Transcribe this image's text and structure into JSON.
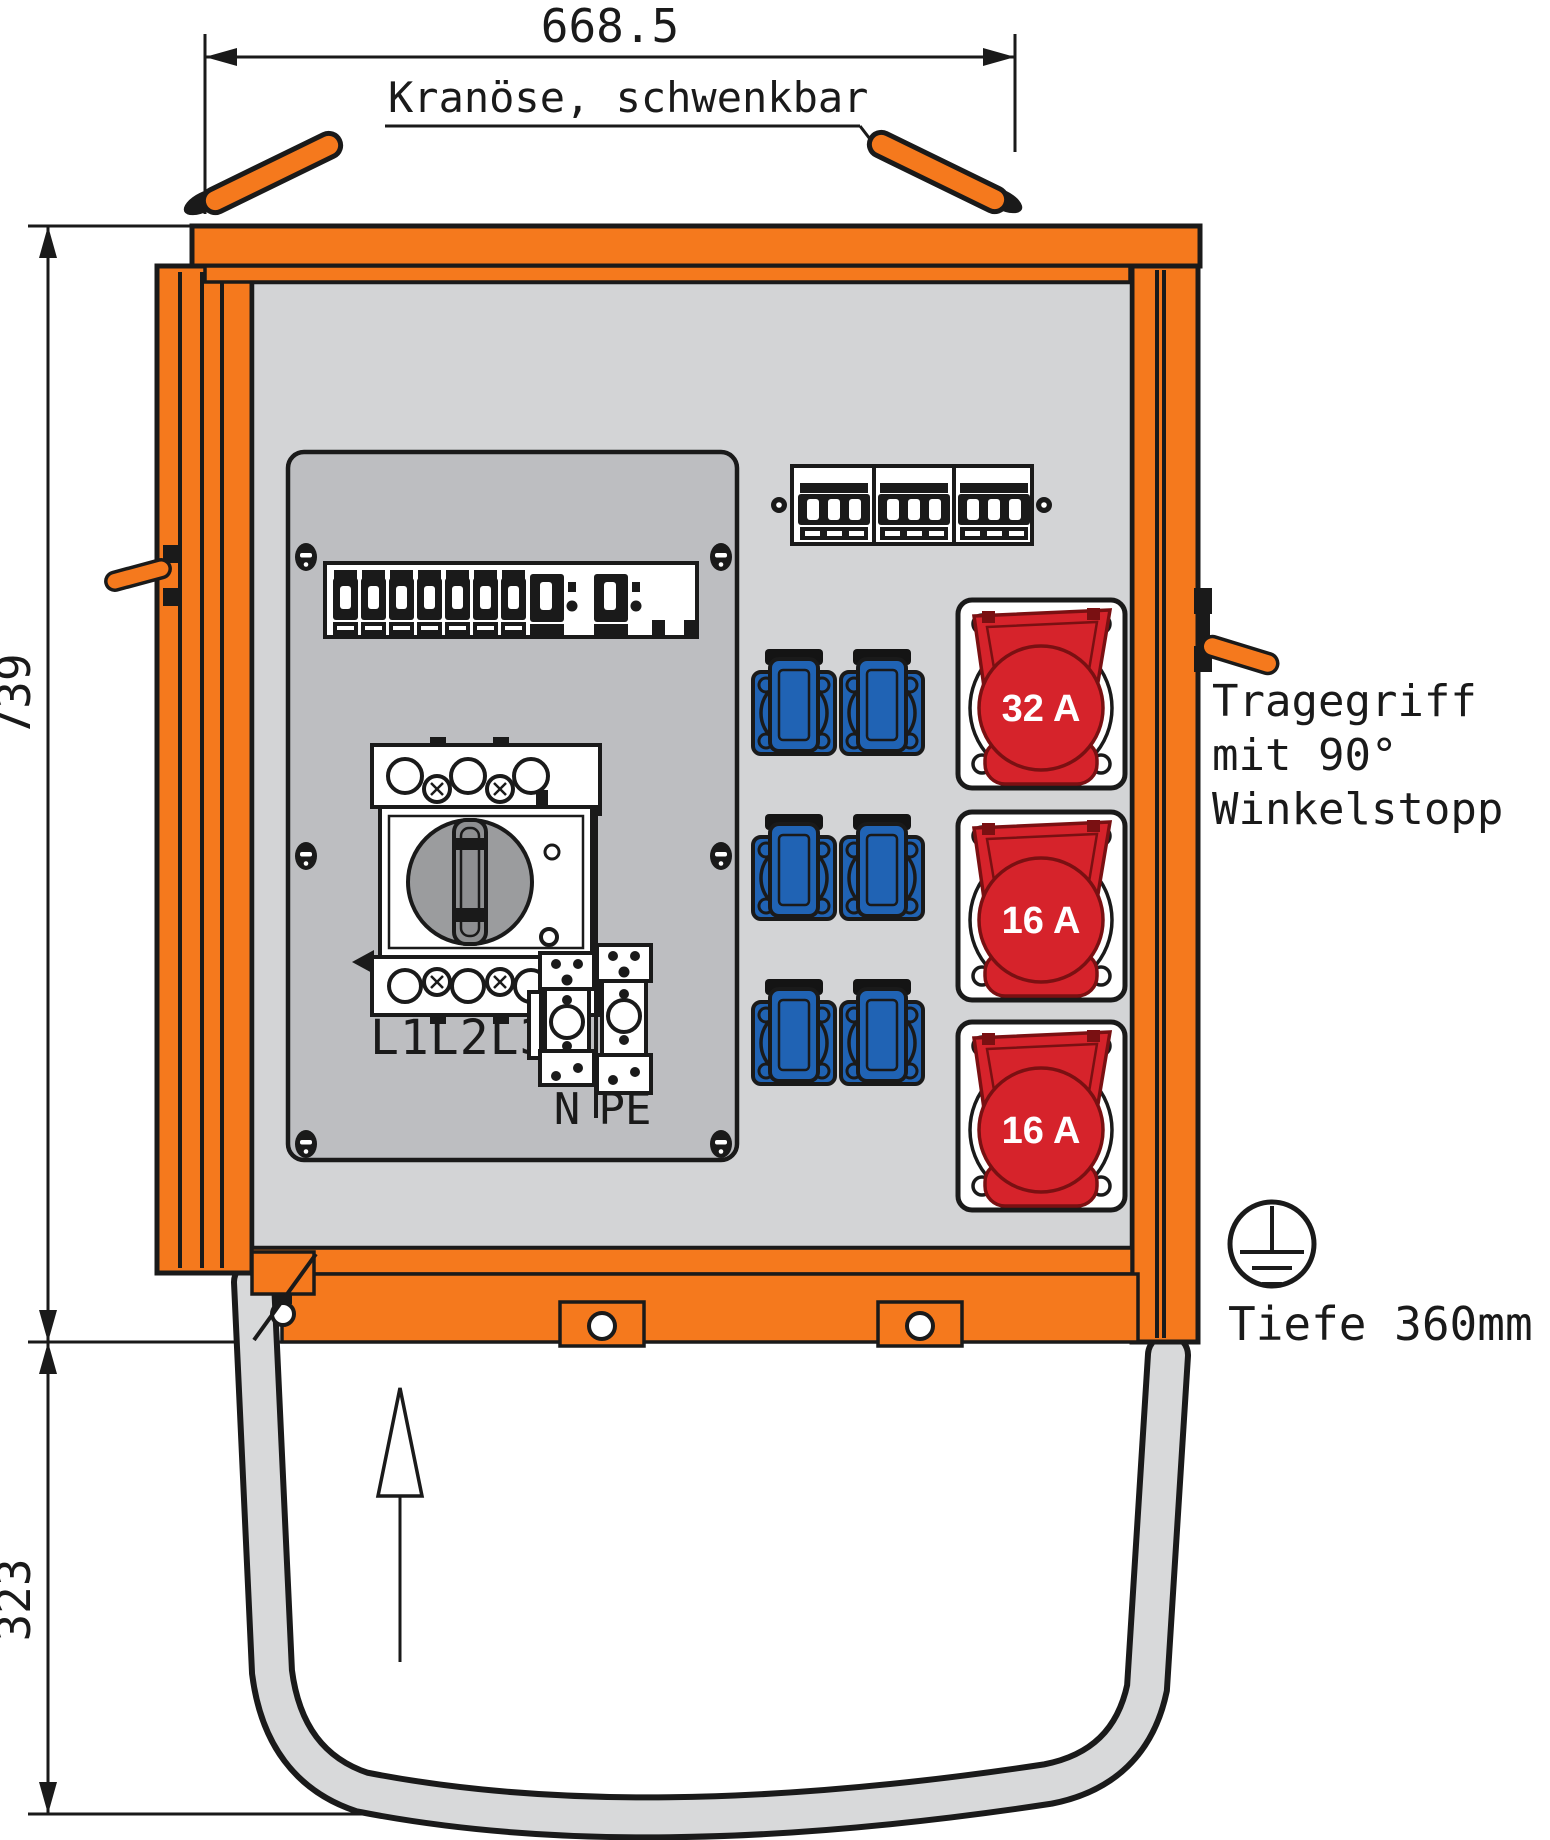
{
  "drawing": {
    "dimensions": {
      "width": "668.5",
      "height_upper": "739",
      "height_lower": "323",
      "depth": "Tiefe 360mm"
    },
    "labels": {
      "crane_eye": "Kranöse, schwenkbar",
      "handle_line1": "Tragegriff",
      "handle_line2": "mit 90°",
      "handle_line3": "Winkelstopp",
      "main_switch": "L1L2L3",
      "terminal_n": "N",
      "terminal_pe": "PE"
    },
    "sockets": {
      "cee": [
        {
          "rating": "32 A"
        },
        {
          "rating": "16 A"
        },
        {
          "rating": "16 A"
        }
      ],
      "schuko_count": 6
    },
    "icons": [
      "ground-earth-symbol",
      "direction-up-arrow"
    ],
    "colors": {
      "orange": "#F5791D",
      "red": "#D6232B",
      "red_dark": "#7A1012",
      "blue": "#2063B4",
      "interior_grey": "#D3D4D6",
      "panel_grey": "#BDBEC1",
      "skid_grey": "#D8D9DA",
      "line": "#1A1A1A"
    }
  }
}
